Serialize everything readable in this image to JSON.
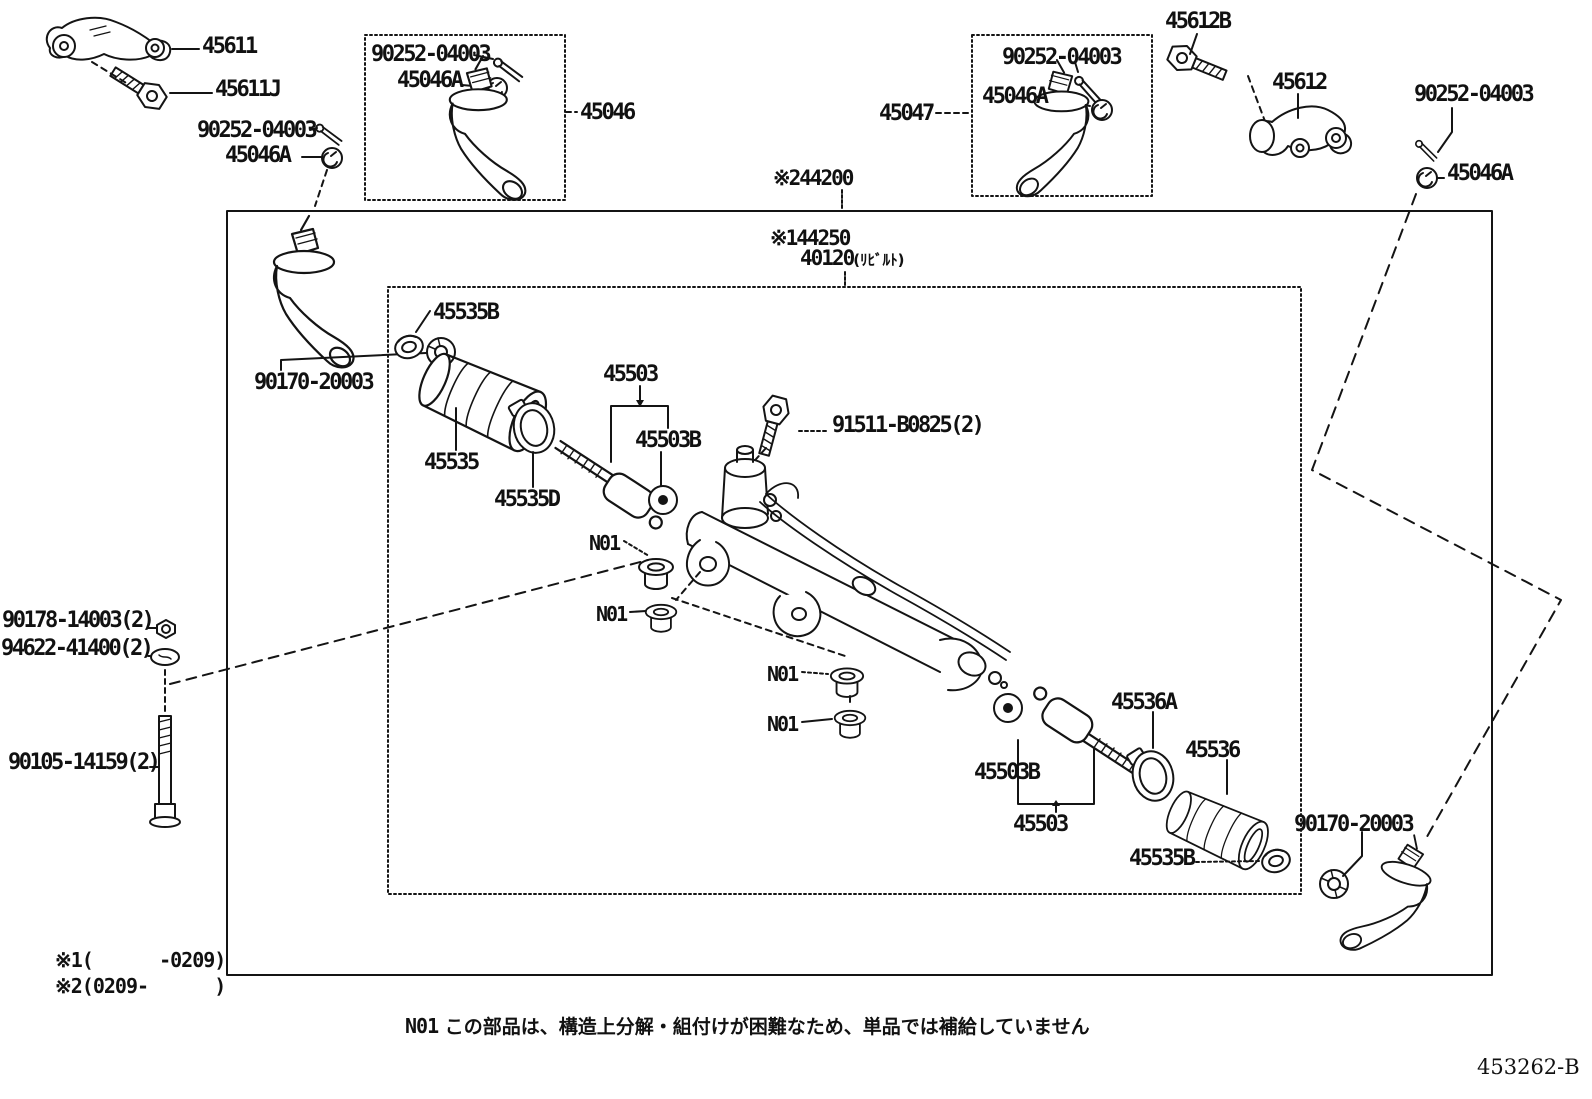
{
  "labels": {
    "l45611": "45611",
    "l45611j": "45611J",
    "l90252_tl": "90252-04003",
    "l45046a_tl": "45046A",
    "l90252_b1": "90252-04003",
    "l45046a_b1": "45046A",
    "l45046": "45046",
    "l45047": "45047",
    "l90252_b2": "90252-04003",
    "l45046a_b2": "45046A",
    "l45612b": "45612B",
    "l45612": "45612",
    "l90252_tr": "90252-04003",
    "l45046a_tr": "45046A",
    "lx244200": "※244200",
    "lx144250": "※144250",
    "l40120": "40120",
    "l40120_suffix": "(ﾘﾋﾞﾙﾄ)",
    "l90170_tl": "90170-20003",
    "l45535b_tl": "45535B",
    "l45503_top": "45503",
    "l45503b_top": "45503B",
    "l91511": "91511-B0825(2)",
    "l45535": "45535",
    "l45535d": "45535D",
    "n01_1": "N01",
    "n01_2": "N01",
    "n01_3": "N01",
    "n01_4": "N01",
    "l90178": "90178-14003(2)",
    "l94622": "94622-41400(2)",
    "l90105": "90105-14159(2)",
    "l45536a": "45536A",
    "l45536": "45536",
    "l45503b_bot": "45503B",
    "l45503_bot": "45503",
    "l45535b_bot": "45535B",
    "l90170_br": "90170-20003"
  },
  "notes": {
    "note1": "※1(      -0209)",
    "note2": "※2(0209-      )",
    "n01_prefix": "N01",
    "n01_text": " この部品は、構造上分解・組付けが困難なため、単品では補給していません",
    "doc_code": "453262-B"
  }
}
